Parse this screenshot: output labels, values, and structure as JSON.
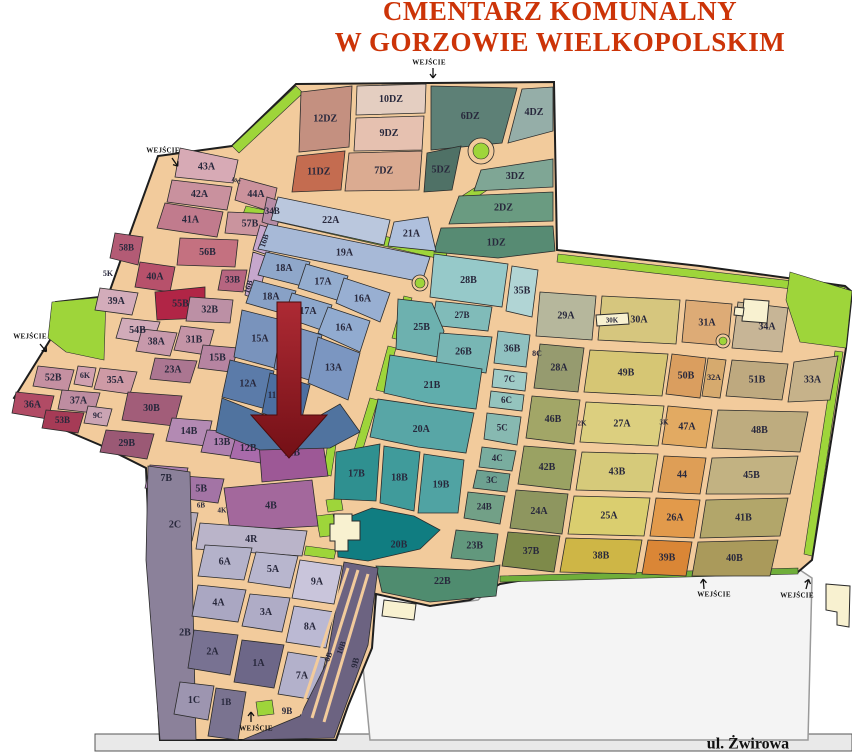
{
  "title": {
    "line1": "CMENTARZ KOMUNALNY",
    "line2": "W GORZOWIE WIELKOPOLSKIM",
    "color": "#cc3408"
  },
  "entrance_label": "WEJŚCIE",
  "street": {
    "x": 95,
    "y": 734,
    "w": 757,
    "h": 17,
    "fill": "#e9e9e9",
    "stroke": "#555",
    "label": "ul. Żwirowa",
    "label_x": 748,
    "label_y": 745
  },
  "parking": {
    "fill": "#f4f4f4",
    "stroke": "#9a9a9a",
    "pts": "374,592 430,606 478,600 500,578 800,570 812,578 808,740 370,740 362,656"
  },
  "base": {
    "fill": "#f2cb9c",
    "stroke": "#1e1e1e",
    "pts": "296,84 554,82 557,250 700,266 845,286 852,292 846,348 812,560 798,572 524,580 500,584 470,600 430,606 376,594 372,648 348,706 336,740 160,740 150,560 146,468 100,445 60,428 14,398 50,340 56,302 108,296 132,228 158,156 232,146"
  },
  "label_color": "#28283c",
  "arrow": {
    "pts": "277,302 301,302 301,415 327,415 289,458 251,415 277,415",
    "from": "#ad2a34",
    "to": "#741016",
    "stroke": "#4c0a0a"
  },
  "greens": [
    {
      "c": "#9ed53a",
      "p": "232,146 296,86 303,93 239,153"
    },
    {
      "c": "#9ed53a",
      "p": "52,302 106,297 104,360 66,352 48,338"
    },
    {
      "c": "#9ed53a",
      "p": "246,206 448,250 445,260 243,214"
    },
    {
      "c": "#9ed53a",
      "p": "494,172 548,161 550,169 496,180"
    },
    {
      "c": "#9ed53a",
      "p": "462,196 505,168 510,175 468,203"
    },
    {
      "c": "#9ed53a",
      "p": "558,254 845,287 844,295 557,262"
    },
    {
      "c": "#9ed53a",
      "p": "790,272 852,291 846,348 800,342 786,300"
    },
    {
      "c": "#9ed53a",
      "p": "843,352 835,351 804,554 812,556"
    },
    {
      "c": "#9ed53a",
      "p": "404,296 412,298 400,340 392,338"
    },
    {
      "c": "#9ed53a",
      "p": "388,346 396,348 384,392 376,390"
    },
    {
      "c": "#9ed53a",
      "p": "370,398 378,400 362,452 354,450"
    },
    {
      "c": "#9ed53a",
      "p": "330,430 338,432 331,476 323,474"
    },
    {
      "c": "#9ed53a",
      "p": "326,500 341,498 343,510 328,512"
    },
    {
      "c": "#9ed53a",
      "p": "316,516 333,514 337,535 320,537"
    },
    {
      "c": "#9ed53a",
      "p": "256,702 272,700 274,714 258,716"
    },
    {
      "c": "#9ed53a",
      "p": "306,546 336,550 334,559 304,555"
    },
    {
      "c": "#6fae3a",
      "p": "500,576 798,568 798,574 500,582"
    }
  ],
  "sections": [
    {
      "l": "12DZ",
      "c": "#c49080",
      "p": "301,92 352,86 349,147 299,152"
    },
    {
      "l": "10DZ",
      "c": "#e4cec1",
      "p": "357,86 426,84 425,113 356,115"
    },
    {
      "l": "9DZ",
      "c": "#e6c1b0",
      "p": "356,118 424,116 422,150 354,151"
    },
    {
      "l": "6DZ",
      "c": "#5d8076",
      "p": "431,86 517,88 502,143 431,150"
    },
    {
      "l": "4DZ",
      "c": "#95aea8",
      "p": "522,89 553,87 553,131 508,143"
    },
    {
      "l": "11DZ",
      "c": "#c46c50",
      "p": "297,156 345,151 341,190 292,192"
    },
    {
      "l": "7DZ",
      "c": "#dbab91",
      "p": "349,153 422,151 419,190 345,191"
    },
    {
      "l": "5DZ",
      "c": "#4f7166",
      "p": "427,153 461,146 452,190 424,192"
    },
    {
      "l": "3DZ",
      "c": "#7fa695",
      "p": "481,170 553,159 553,187 474,191"
    },
    {
      "l": "2DZ",
      "c": "#6a9b81",
      "p": "459,196 553,192 553,221 449,224"
    },
    {
      "l": "1DZ",
      "c": "#578b73",
      "p": "441,228 553,226 555,251 498,258 434,252"
    },
    {
      "l": "43A",
      "c": "#d7aab5",
      "p": "180,148 238,160 233,183 175,177"
    },
    {
      "l": "42A",
      "c": "#c9919e",
      "p": "172,180 232,187 227,210 167,202"
    },
    {
      "l": "44A",
      "c": "#cb929c",
      "p": "240,178 277,188 272,212 235,200"
    },
    {
      "l": "41A",
      "c": "#c17b8d",
      "p": "165,203 223,212 217,237 157,228"
    },
    {
      "l": "57B",
      "c": "#ca949e",
      "p": "228,212 275,214 272,237 225,233"
    },
    {
      "l": "34B",
      "c": "#b68ca5",
      "p": "267,197 283,202 277,227 262,222",
      "fs": 9
    },
    {
      "l": "58B",
      "c": "#b35b75",
      "p": "115,233 143,237 138,265 110,258",
      "fs": 9
    },
    {
      "l": "56B",
      "c": "#c47180",
      "p": "180,238 238,240 235,267 177,265"
    },
    {
      "l": "40A",
      "c": "#b7516b",
      "p": "140,262 175,267 170,292 135,287"
    },
    {
      "l": "55B",
      "c": "#b12546",
      "p": "155,292 205,287 205,318 157,320"
    },
    {
      "l": "33B",
      "c": "#b66580",
      "p": "222,270 247,270 243,292 218,290",
      "fs": 9
    },
    {
      "l": "",
      "nl": true,
      "c": "#c6a7cd",
      "p": "260,225 277,230 268,255 253,250"
    },
    {
      "l": "",
      "nl": true,
      "c": "#c6a7cd",
      "p": "253,252 268,257 258,300 245,295"
    },
    {
      "l": "39A",
      "c": "#d3acba",
      "p": "100,288 138,293 132,315 95,310"
    },
    {
      "l": "54B",
      "c": "#d1abb9",
      "p": "122,318 160,322 152,344 116,338"
    },
    {
      "l": "38A",
      "c": "#c799ab",
      "p": "142,329 177,333 170,356 136,351"
    },
    {
      "l": "31B",
      "c": "#c494a6",
      "p": "181,326 214,330 207,355 174,350"
    },
    {
      "l": "23A",
      "c": "#ab7691",
      "p": "155,358 197,361 190,383 150,379"
    },
    {
      "l": "15B",
      "c": "#b684a1",
      "p": "203,345 238,348 231,372 198,368"
    },
    {
      "l": "32B",
      "c": "#bc90a5",
      "p": "190,297 233,300 230,323 186,321"
    },
    {
      "l": "52B",
      "c": "#c590a1",
      "p": "38,366 74,370 68,391 33,386"
    },
    {
      "l": "6K",
      "c": "#d0a0af",
      "p": "78,366 96,368 92,387 74,384",
      "fs": 8
    },
    {
      "l": "35A",
      "c": "#ce9aa5",
      "p": "100,368 137,372 130,394 94,389"
    },
    {
      "l": "36A",
      "c": "#b14b65",
      "p": "16,392 54,396 48,419 12,413"
    },
    {
      "l": "37A",
      "c": "#be8da1",
      "p": "62,390 100,393 94,413 58,409"
    },
    {
      "l": "9C",
      "c": "#caa4b3",
      "p": "88,406 112,409 107,426 84,423",
      "fs": 8
    },
    {
      "l": "53B",
      "c": "#a63b56",
      "p": "46,410 84,413 78,433 42,428",
      "fs": 9
    },
    {
      "l": "30B",
      "c": "#a25d79",
      "p": "128,392 182,396 174,426 122,420"
    },
    {
      "l": "29B",
      "c": "#9b5975",
      "p": "106,430 154,434 147,459 100,452"
    },
    {
      "l": "14B",
      "c": "#b38ab3",
      "p": "172,418 212,421 206,446 166,441"
    },
    {
      "l": "13B",
      "c": "#ae80af",
      "p": "207,430 243,432 237,457 201,452"
    },
    {
      "l": "12B",
      "c": "#a96bab",
      "p": "236,436 266,438 261,463 230,458"
    },
    {
      "l": "11B",
      "c": "#9d5896",
      "p": "258,430 320,424 328,476 262,482"
    },
    {
      "l": "7B",
      "c": "#aa80af",
      "p": "150,465 188,468 182,493 145,488"
    },
    {
      "l": "5B",
      "c": "#a374a5",
      "p": "184,476 224,479 218,503 179,498"
    },
    {
      "l": "4B",
      "c": "#a3689c",
      "p": "224,488 312,480 318,526 230,531"
    },
    {
      "l": "2C",
      "c": "#b3abbb",
      "p": "158,510 198,513 192,541 152,537"
    },
    {
      "l": "4R",
      "c": "#bab4c9",
      "p": "200,523 307,531 302,556 196,549"
    },
    {
      "l": "22A",
      "c": "#bac7dd",
      "p": "278,197 390,220 384,245 271,220"
    },
    {
      "l": "21A",
      "c": "#afc0dd",
      "p": "394,222 428,217 436,251 388,246"
    },
    {
      "l": "19A",
      "c": "#a7b9d7",
      "p": "268,224 430,257 422,282 258,249"
    },
    {
      "l": "18A",
      "c": "#8fa7ca",
      "p": "266,252 310,262 302,286 258,275"
    },
    {
      "l": "17A",
      "c": "#94adcf",
      "p": "306,264 348,276 340,301 298,288"
    },
    {
      "l": "16A",
      "c": "#98afd2",
      "p": "344,278 390,293 380,322 336,303"
    },
    {
      "l": "18A",
      "c": "#88a1c6",
      "p": "254,280 296,291 288,315 246,303"
    },
    {
      "l": "17A",
      "c": "#8da7cb",
      "p": "292,293 332,305 324,331 284,317"
    },
    {
      "l": "16A",
      "c": "#91abd0",
      "p": "328,307 370,321 360,352 318,333"
    },
    {
      "l": "15A",
      "c": "#7993bc",
      "p": "242,310 286,321 278,369 234,357"
    },
    {
      "l": "",
      "nl": true,
      "c": "#7e97c0",
      "p": "282,323 322,335 312,381 274,369"
    },
    {
      "l": "13A",
      "c": "#7b96c1",
      "p": "318,337 360,353 348,400 308,383"
    },
    {
      "l": "12A",
      "c": "#5b7ba9",
      "p": "230,360 274,371 266,409 222,397"
    },
    {
      "l": "",
      "nl": true,
      "c": "#4c6fa1",
      "p": "270,373 310,385 300,426 262,413"
    },
    {
      "l": "",
      "nl": true,
      "c": "#50739f",
      "p": "222,398 262,414 300,427 340,404 360,432 330,448 260,450 216,432"
    },
    {
      "l": "28B",
      "c": "#96c9c9",
      "p": "434,254 508,264 502,307 430,297"
    },
    {
      "l": "35B",
      "c": "#b1d5d5",
      "p": "512,266 538,270 532,317 506,311"
    },
    {
      "l": "27B",
      "c": "#80bbb9",
      "p": "436,301 492,307 488,331 432,325",
      "fs": 9
    },
    {
      "l": "25B",
      "c": "#6db1af",
      "p": "398,299 432,303 444,331 438,357 396,349"
    },
    {
      "l": "26B",
      "c": "#78b6b4",
      "p": "440,333 492,337 486,373 436,365"
    },
    {
      "l": "36B",
      "c": "#90c1c0",
      "p": "498,331 530,335 526,367 494,363"
    },
    {
      "l": "7C",
      "c": "#9fcbc7",
      "p": "494,369 527,373 525,391 492,387",
      "fs": 9
    },
    {
      "l": "6C",
      "c": "#94c4be",
      "p": "491,391 524,395 522,411 489,407",
      "fs": 9
    },
    {
      "l": "21B",
      "c": "#60adac",
      "p": "390,355 482,369 476,409 428,403 384,393"
    },
    {
      "l": "5C",
      "c": "#87b9b1",
      "p": "487,413 521,417 517,445 484,439",
      "fs": 9
    },
    {
      "l": "20A",
      "c": "#58a6a6",
      "p": "378,399 474,413 466,453 418,447 370,437"
    },
    {
      "l": "4C",
      "c": "#79ad9f",
      "p": "482,447 516,451 512,471 479,467",
      "fs": 9
    },
    {
      "l": "3C",
      "c": "#6da191",
      "p": "477,470 510,474 507,492 473,488",
      "fs": 9
    },
    {
      "l": "17B",
      "c": "#2f9090",
      "p": "336,452 380,444 376,501 334,499"
    },
    {
      "l": "18B",
      "c": "#409b9b",
      "p": "384,446 420,452 414,511 380,503"
    },
    {
      "l": "19B",
      "c": "#50a3a3",
      "p": "424,454 464,460 458,513 418,513"
    },
    {
      "l": "24B",
      "c": "#72a087",
      "p": "468,492 505,496 500,524 464,518",
      "fs": 9
    },
    {
      "l": "20B",
      "c": "#107d81",
      "p": "336,522 372,508 414,516 440,530 420,549 368,561 338,557",
      "lx": 399,
      "ly": 545
    },
    {
      "l": "23B",
      "c": "#62987d",
      "p": "456,530 498,534 494,562 451,558"
    },
    {
      "l": "22B",
      "c": "#4f8c6f",
      "p": "376,566 470,570 500,565 496,596 430,602 382,592"
    },
    {
      "l": "29A",
      "c": "#b6b79c",
      "p": "540,292 596,296 592,340 536,336"
    },
    {
      "l": "30A",
      "c": "#d6c67e",
      "p": "602,296 680,300 676,344 598,340"
    },
    {
      "l": "31A",
      "c": "#ddab76",
      "p": "686,300 732,304 728,346 682,342"
    },
    {
      "l": "34A",
      "c": "#c7b596",
      "p": "738,302 788,308 782,352 732,348",
      "lx": 767,
      "ly": 327
    },
    {
      "l": "28A",
      "c": "#969b6f",
      "p": "540,344 584,348 578,392 534,388"
    },
    {
      "l": "49B",
      "c": "#d6c674",
      "p": "590,350 668,354 662,396 584,392"
    },
    {
      "l": "50B",
      "c": "#da9e5f",
      "p": "672,354 706,358 700,398 666,394"
    },
    {
      "l": "32A",
      "c": "#d6aa6e",
      "p": "708,358 726,360 720,398 702,396",
      "fs": 8
    },
    {
      "l": "51B",
      "c": "#bea97f",
      "p": "732,360 788,364 782,400 726,396"
    },
    {
      "l": "33A",
      "c": "#c6b28a",
      "p": "794,362 838,356 830,400 788,402"
    },
    {
      "l": "46B",
      "c": "#a2a667",
      "p": "532,396 580,400 574,444 526,438"
    },
    {
      "l": "27A",
      "c": "#dccf7f",
      "p": "586,402 664,406 658,446 580,442"
    },
    {
      "l": "47A",
      "c": "#e2aa62",
      "p": "668,406 712,410 706,448 662,444"
    },
    {
      "l": "48B",
      "c": "#beac7f",
      "p": "718,410 808,412 800,452 712,448"
    },
    {
      "l": "42B",
      "c": "#9aa263",
      "p": "524,446 576,450 570,490 518,484"
    },
    {
      "l": "43B",
      "c": "#d6ca7a",
      "p": "582,452 658,454 652,492 576,490"
    },
    {
      "l": "44",
      "c": "#de9e56",
      "p": "664,456 706,458 700,494 658,492"
    },
    {
      "l": "45B",
      "c": "#c2b282",
      "p": "712,458 798,456 790,494 706,494"
    },
    {
      "l": "24A",
      "c": "#8e965f",
      "p": "516,490 568,494 562,534 510,528"
    },
    {
      "l": "25A",
      "c": "#dace6f",
      "p": "574,496 650,498 644,536 568,534"
    },
    {
      "l": "26A",
      "c": "#e29a4b",
      "p": "656,498 700,500 694,538 650,536"
    },
    {
      "l": "41B",
      "c": "#b2a66a",
      "p": "706,500 788,498 780,536 700,538"
    },
    {
      "l": "37B",
      "c": "#7e8a4a",
      "p": "508,532 560,536 554,572 502,566"
    },
    {
      "l": "38B",
      "c": "#ceb646",
      "p": "566,538 642,540 636,574 560,572"
    },
    {
      "l": "39B",
      "c": "#da8636",
      "p": "648,540 692,542 686,576 642,574"
    },
    {
      "l": "40B",
      "c": "#aa9a5b",
      "p": "698,542 778,540 770,576 692,576"
    },
    {
      "l": "2B",
      "c": "#8b819a",
      "p": "148,466 190,472 196,740 160,740 146,560",
      "lx": 185,
      "ly": 633
    },
    {
      "l": "6A",
      "c": "#b4b2ca",
      "p": "205,545 252,548 244,580 198,576"
    },
    {
      "l": "5A",
      "c": "#b8b6ce",
      "p": "256,552 298,556 290,588 248,582"
    },
    {
      "l": "9A",
      "c": "#c9c5db",
      "p": "300,560 342,566 334,604 292,598"
    },
    {
      "l": "4A",
      "c": "#aaa7c2",
      "p": "198,585 246,590 238,622 192,616"
    },
    {
      "l": "3A",
      "c": "#afacc6",
      "p": "250,594 290,598 282,632 242,626"
    },
    {
      "l": "8A",
      "c": "#bbb9d3",
      "p": "294,606 334,612 326,648 286,642"
    },
    {
      "l": "2A",
      "c": "#787292",
      "p": "194,630 238,635 230,675 188,668"
    },
    {
      "l": "1A",
      "c": "#6d6788",
      "p": "242,640 284,645 274,688 234,682"
    },
    {
      "l": "7A",
      "c": "#b3b1cb",
      "p": "288,652 326,658 316,700 278,694"
    },
    {
      "l": "1C",
      "c": "#9d95b0",
      "p": "180,682 214,686 208,720 174,714"
    },
    {
      "l": "",
      "nl": true,
      "c": "#6c6381",
      "p": "344,562 378,568 368,645 346,705 334,738 242,740 300,716 326,664"
    },
    {
      "l": "",
      "nl": true,
      "c": "#7a7390",
      "p": "216,688 246,692 238,740 208,736"
    }
  ],
  "strip_roads": [
    {
      "p": "348,568 300,714",
      "w": 3
    },
    {
      "p": "358,570 312,718",
      "w": 3
    },
    {
      "p": "368,574 324,722",
      "w": 3
    }
  ],
  "roundabouts": [
    {
      "cx": 481,
      "cy": 151,
      "r": 13,
      "ir": 8
    },
    {
      "cx": 723,
      "cy": 341,
      "r": 7,
      "ir": 4
    },
    {
      "cx": 420,
      "cy": 283,
      "r": 8,
      "ir": 5
    }
  ],
  "buildings": [
    {
      "p": "334,514 352,514 352,521 360,521 360,540 348,540 348,551 335,551 335,541 330,541 330,524 334,524"
    },
    {
      "p": "744,299 769,301 767,323 742,321"
    },
    {
      "p": "735,307 744,308 743,316 734,315"
    },
    {
      "p": "826,584 850,586 849,627 837,625 837,612 826,610"
    },
    {
      "p": "384,600 416,604 414,620 382,616"
    },
    {
      "p": "596,315 628,313 629,324 597,326"
    }
  ],
  "floating_labels": [
    {
      "t": "11",
      "x": 272,
      "y": 396,
      "fs": 9
    },
    {
      "t": "16B",
      "x": 265,
      "y": 241,
      "fs": 8,
      "rot": -72
    },
    {
      "t": "16B",
      "x": 249,
      "y": 287,
      "fs": 8,
      "rot": -72
    },
    {
      "t": "8B",
      "x": 329,
      "y": 657,
      "fs": 8,
      "rot": -70
    },
    {
      "t": "10B",
      "x": 342,
      "y": 648,
      "fs": 8,
      "rot": -70
    },
    {
      "t": "9B",
      "x": 356,
      "y": 663,
      "fs": 9,
      "rot": -75
    },
    {
      "t": "9B",
      "x": 287,
      "y": 712,
      "fs": 9
    },
    {
      "t": "1B",
      "x": 226,
      "y": 703,
      "fs": 9
    },
    {
      "t": "2K",
      "x": 582,
      "y": 424,
      "fs": 7
    },
    {
      "t": "3K",
      "x": 664,
      "y": 423,
      "fs": 7
    },
    {
      "t": "30K",
      "x": 612,
      "y": 321,
      "fs": 7
    },
    {
      "t": "8C",
      "x": 537,
      "y": 354,
      "fs": 8
    },
    {
      "t": "10C",
      "x": 236,
      "y": 181,
      "fs": 6,
      "rot": 25
    },
    {
      "t": "5K",
      "x": 108,
      "y": 274,
      "fs": 8
    },
    {
      "t": "6B",
      "x": 201,
      "y": 506,
      "fs": 7
    },
    {
      "t": "4K",
      "x": 222,
      "y": 511,
      "fs": 7
    }
  ],
  "entrances": [
    {
      "x": 429,
      "y": 63,
      "ax": 433,
      "ay": 68,
      "deg": 90
    },
    {
      "x": 163,
      "y": 151,
      "ax": 172,
      "ay": 158,
      "deg": 55
    },
    {
      "x": 30,
      "y": 337,
      "ax": 40,
      "ay": 344,
      "deg": 50
    },
    {
      "x": 256,
      "y": 729,
      "ax": 251,
      "ay": 722,
      "deg": 270
    },
    {
      "x": 714,
      "y": 595,
      "ax": 704,
      "ay": 589,
      "deg": 265
    },
    {
      "x": 797,
      "y": 596,
      "ax": 806,
      "ay": 589,
      "deg": 285
    }
  ]
}
